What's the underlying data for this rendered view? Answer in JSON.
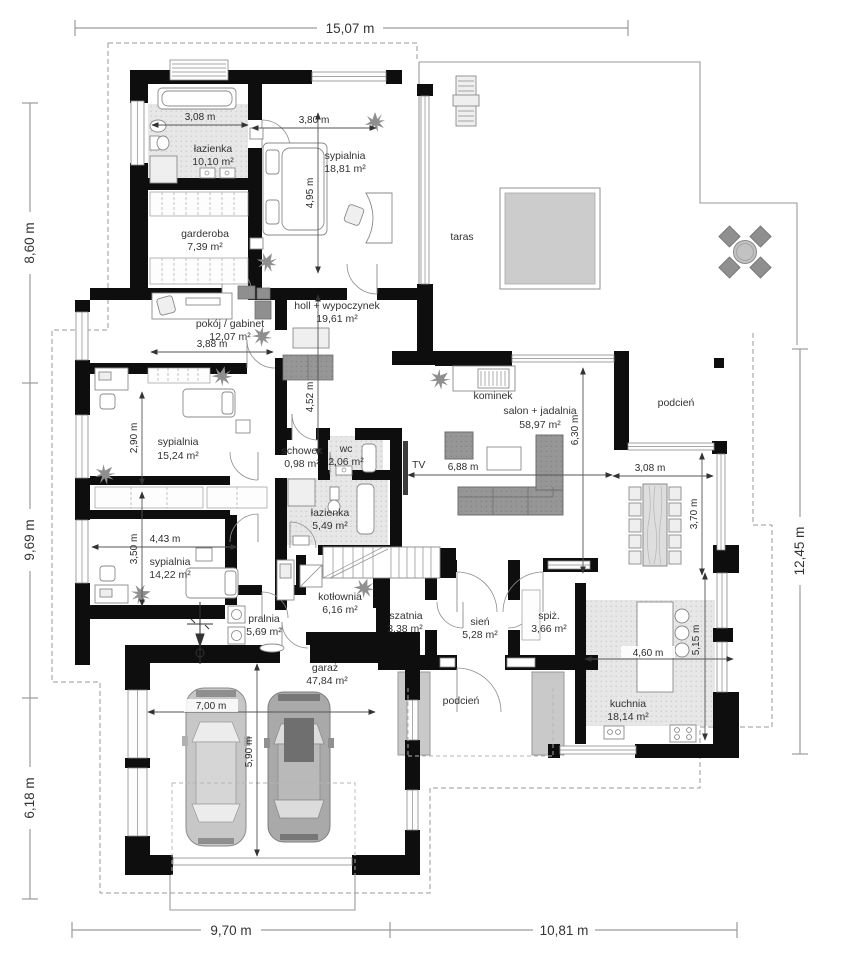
{
  "plan": {
    "rooms": {
      "lazienka1": {
        "label": "łazienka",
        "area": "10,10 m²"
      },
      "sypialnia1": {
        "label": "sypialnia",
        "area": "18,81 m²"
      },
      "garderoba": {
        "label": "garderoba",
        "area": "7,39 m²"
      },
      "pokoj_gabinet": {
        "label": "pokój / gabinet",
        "area": "12,07 m²"
      },
      "holl": {
        "label": "holl + wypoczynek",
        "area": "19,61 m²"
      },
      "taras": {
        "label": "taras"
      },
      "kominek": {
        "label": "kominek"
      },
      "salon_jadalnia": {
        "label": "salon + jadalnia",
        "area": "58,97 m²"
      },
      "podcien_gorny": {
        "label": "podcień"
      },
      "sypialnia2": {
        "label": "sypialnia",
        "area": "15,24 m²"
      },
      "schowek": {
        "label": "schowek",
        "area": "0,98 m²"
      },
      "wc": {
        "label": "wc",
        "area": "2,06 m²"
      },
      "tv": {
        "label": "TV"
      },
      "lazienka2": {
        "label": "łazienka",
        "area": "5,49 m²"
      },
      "sypialnia3": {
        "label": "sypialnia",
        "area": "14,22 m²"
      },
      "pralnia": {
        "label": "pralnia",
        "area": "5,69 m²"
      },
      "kotlownia": {
        "label": "kotłownia",
        "area": "6,16 m²"
      },
      "szatnia": {
        "label": "szatnia",
        "area": "3,38 m²"
      },
      "sien": {
        "label": "sień",
        "area": "5,28 m²"
      },
      "spiz": {
        "label": "spiż.",
        "area": "3,66 m²"
      },
      "kuchnia": {
        "label": "kuchnia",
        "area": "18,14 m²"
      },
      "garaz": {
        "label": "garaż",
        "area": "47,84 m²"
      },
      "podcien_wejscie": {
        "label": "podcień"
      }
    },
    "exterior_dims": {
      "top": "15,07 m",
      "left_upper": "8,60 m",
      "left_middle": "9,69 m",
      "left_lower": "6,18 m",
      "right": "12,45 m",
      "bottom_left": "9,70 m",
      "bottom_right": "10,81 m"
    },
    "interior_dims": {
      "lazienka1_w": "3,08 m",
      "sypialnia1_w": "3,80 m",
      "sypialnia1_h": "4,95 m",
      "pokoj_w": "3,88 m",
      "holl_h": "4,52 m",
      "sypialnia2_h": "2,90 m",
      "sypialnia3_h": "3,50 m",
      "sypialnia3_w": "4,43 m",
      "salon_w": "6,88 m",
      "salon_h": "6,30 m",
      "jadalnia_w": "3,08 m",
      "jadalnia_h": "3,70 m",
      "garaz_w": "7,00 m",
      "garaz_h": "5,90 m",
      "kuchnia_w": "4,60 m",
      "kuchnia_h": "5,15 m"
    },
    "colors": {
      "wall": "#0e0e0e",
      "bath_floor": "#e7e7e7",
      "terrace_square": "#cccccc",
      "furniture_dark": "#8f8f8f",
      "dimension_text": "#2b2b2b"
    }
  }
}
